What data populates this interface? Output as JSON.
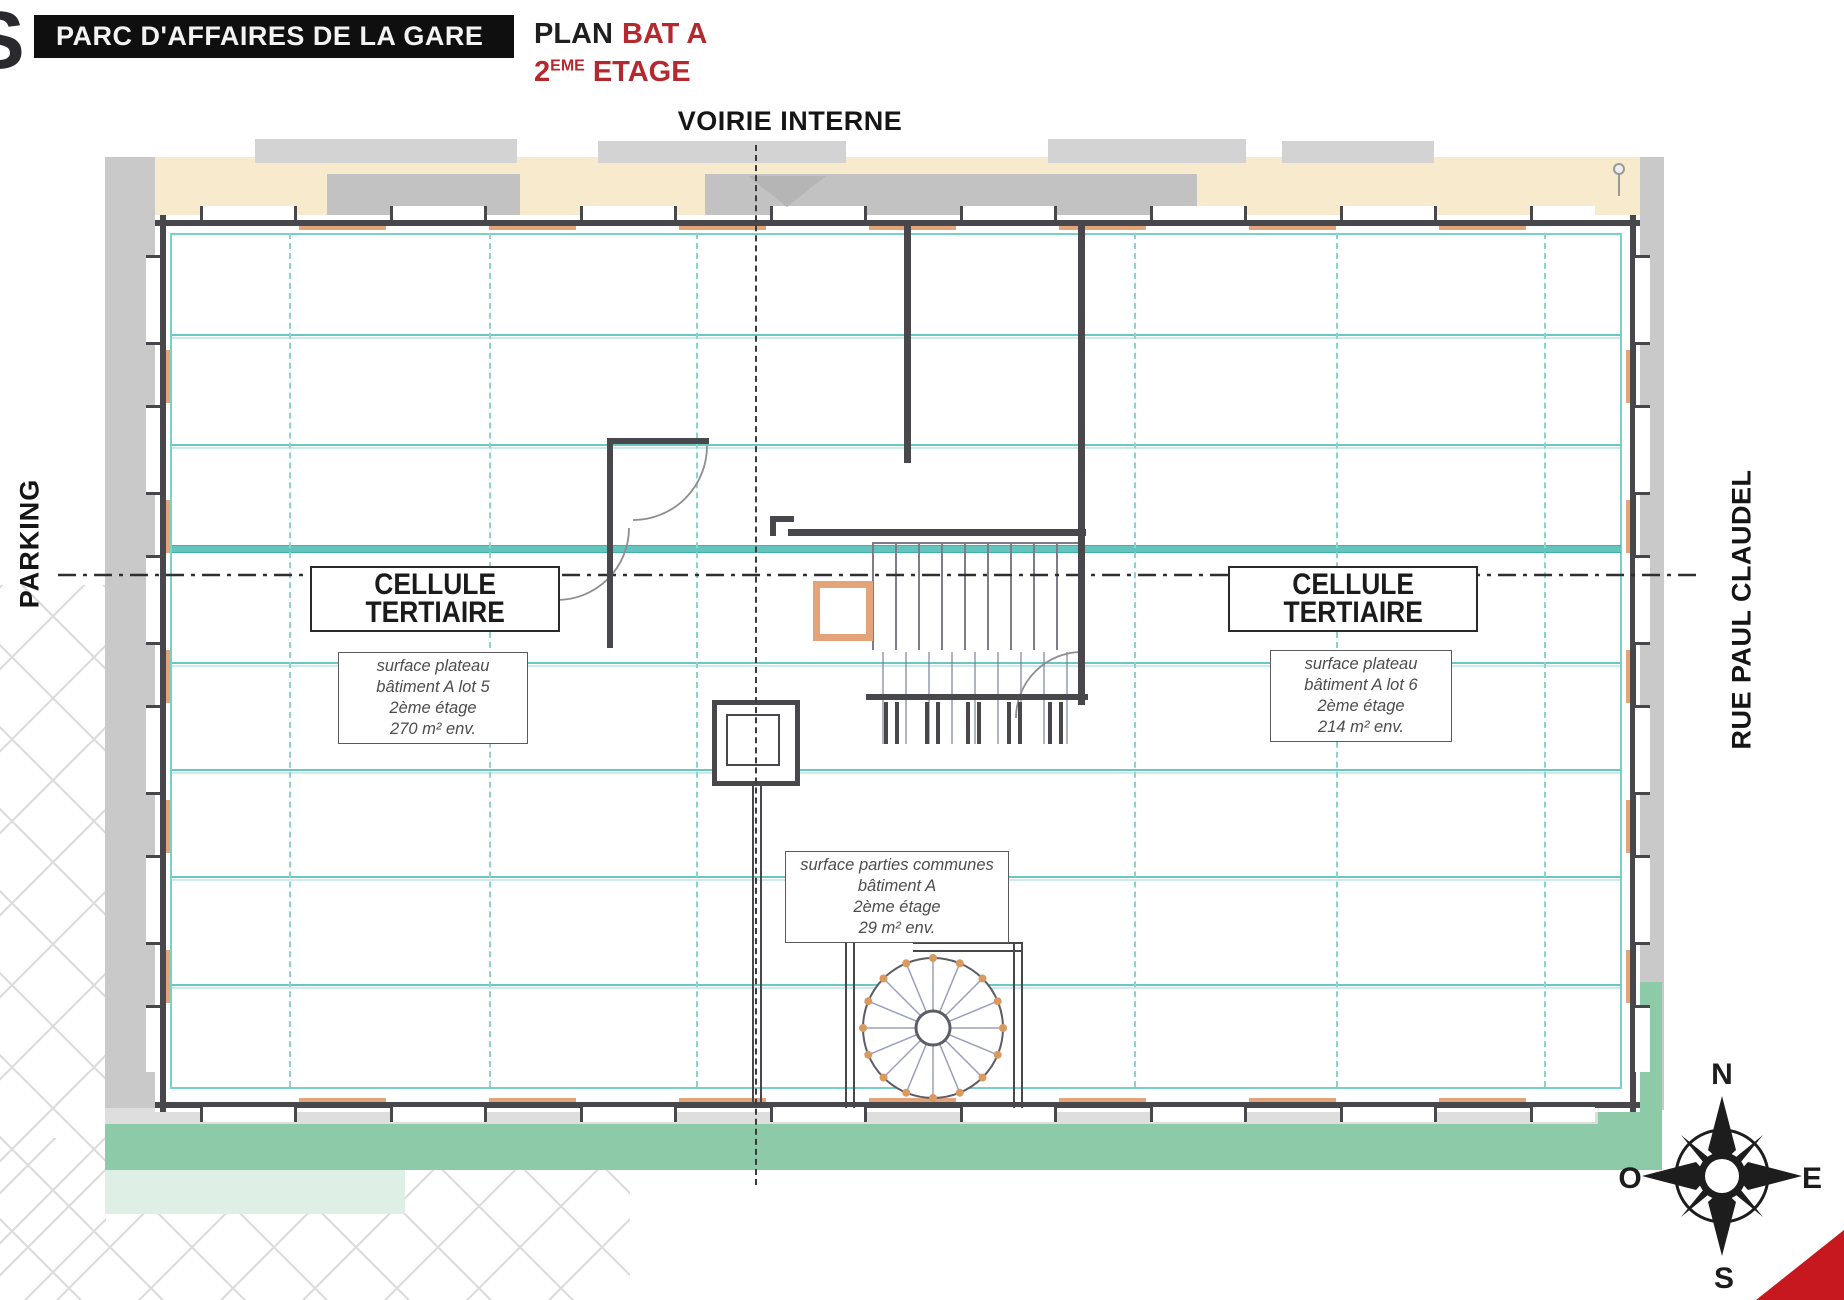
{
  "header": {
    "logo_glyph": "S",
    "project_title": "PARC D'AFFAIRES DE LA GARE",
    "plan_word": "PLAN",
    "building_label": "BAT A",
    "floor_number": "2",
    "floor_ordinal": "EME",
    "floor_word": "ETAGE"
  },
  "streets": {
    "top": "VOIRIE INTERNE",
    "left": "PARKING",
    "right": "RUE PAUL CLAUDEL"
  },
  "units": {
    "left_cell": {
      "label_line1": "CELLULE",
      "label_line2": "TERTIAIRE",
      "note": {
        "l1": "surface plateau",
        "l2": "bâtiment A lot 5",
        "l3": "2ème étage",
        "l4": "270 m² env."
      }
    },
    "right_cell": {
      "label_line1": "CELLULE",
      "label_line2": "TERTIAIRE",
      "note": {
        "l1": "surface plateau",
        "l2": "bâtiment A lot 6",
        "l3": "2ème étage",
        "l4": "214 m² env."
      }
    },
    "commons": {
      "note": {
        "l1": "surface parties communes",
        "l2": "bâtiment A",
        "l3": "2ème étage",
        "l4": "29 m² env."
      }
    }
  },
  "compass": {
    "n": "N",
    "e": "E",
    "s": "S",
    "o": "O"
  },
  "colors": {
    "accent_red": "#b4282e",
    "corner_triangle_red": "#c7181f",
    "teal_grid": "#69c8c1",
    "wall_dark": "#47474c",
    "window_orange": "#e2a478",
    "road_beige": "#f8eacd",
    "lawn_green": "#8ccaa8"
  }
}
